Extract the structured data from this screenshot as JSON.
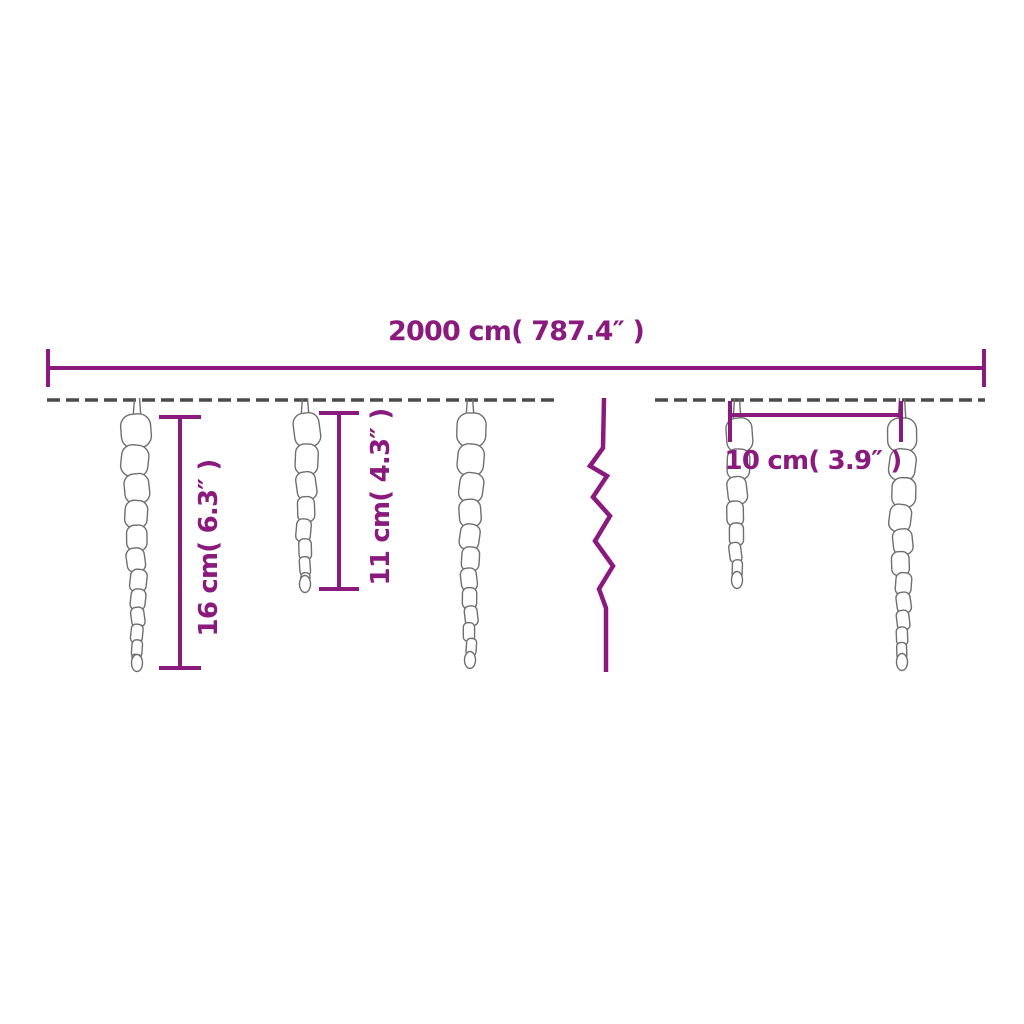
{
  "measurements": {
    "total_length": {
      "label": "2000 cm( 787.4″ )",
      "cm": 2000,
      "inches": 787.4
    },
    "icicle_height_large": {
      "label": "16 cm( 6.3″ )",
      "cm": 16,
      "inches": 6.3
    },
    "icicle_height_small": {
      "label": "11 cm( 4.3″ )",
      "cm": 11,
      "inches": 4.3
    },
    "icicle_spacing": {
      "label": "10 cm( 3.9″ )",
      "cm": 10,
      "inches": 3.9
    }
  },
  "colors": {
    "dimension": "#8a1a7d",
    "wire": "#4a4a4a",
    "icicle_outline": "#6f6f6f",
    "background": "#ffffff"
  },
  "icons": {
    "break_symbol": "zigzag-break-icon"
  }
}
